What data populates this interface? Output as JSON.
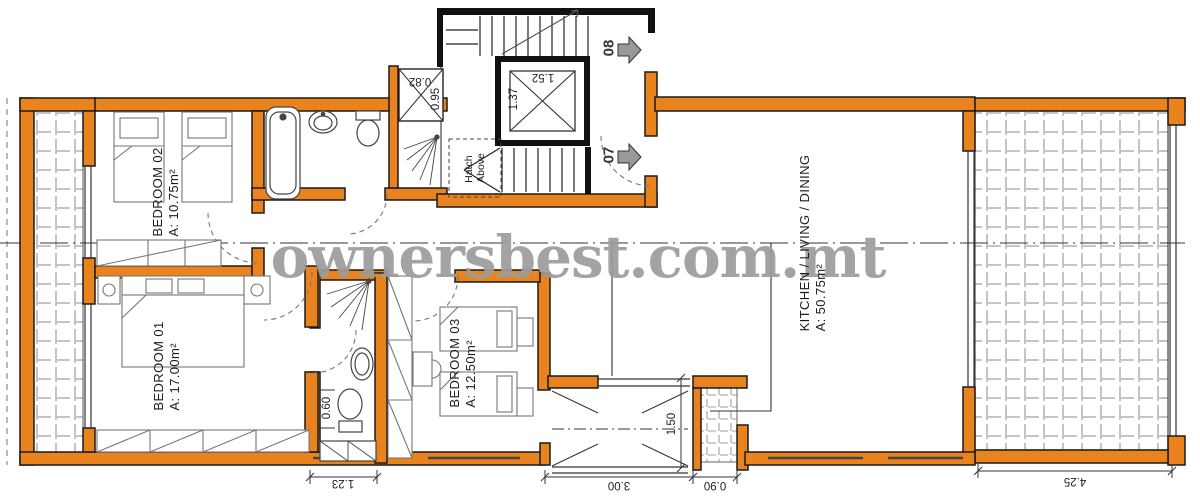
{
  "watermark": "ownersbest.com.mt",
  "colors": {
    "wall_orange": "#E8831D",
    "wall_black": "#111111",
    "tile_line": "#c4c4c4",
    "watermark_gray": "#9c9c9c",
    "arrow_gray": "#999999"
  },
  "rooms": {
    "bedroom02": {
      "name": "BEDROOM 02",
      "area": "A: 10.75m²"
    },
    "bedroom01": {
      "name": "BEDROOM 01",
      "area": "A: 17.00m²"
    },
    "bedroom03": {
      "name": "BEDROOM 03",
      "area": "A: 12.50m²"
    },
    "kitchen": {
      "name": "KITCHEN / LIVING / DINING",
      "area": "A: 50.75m²"
    }
  },
  "units": {
    "unit08": "08",
    "unit07": "07"
  },
  "annotations": {
    "hatch_line1": "Hatch",
    "hatch_line2": "Above"
  },
  "dimensions": {
    "lift_width": "1.52",
    "lift_depth": "1.37",
    "duct_width": "0.82",
    "duct_depth": "0.95",
    "ensuite_width": "0.60",
    "balcony_depth": "1.50",
    "wardrobe_width": "1.23",
    "balcony_width": "3.00",
    "shaft_width": "0.90",
    "terrace_width": "4.25"
  }
}
